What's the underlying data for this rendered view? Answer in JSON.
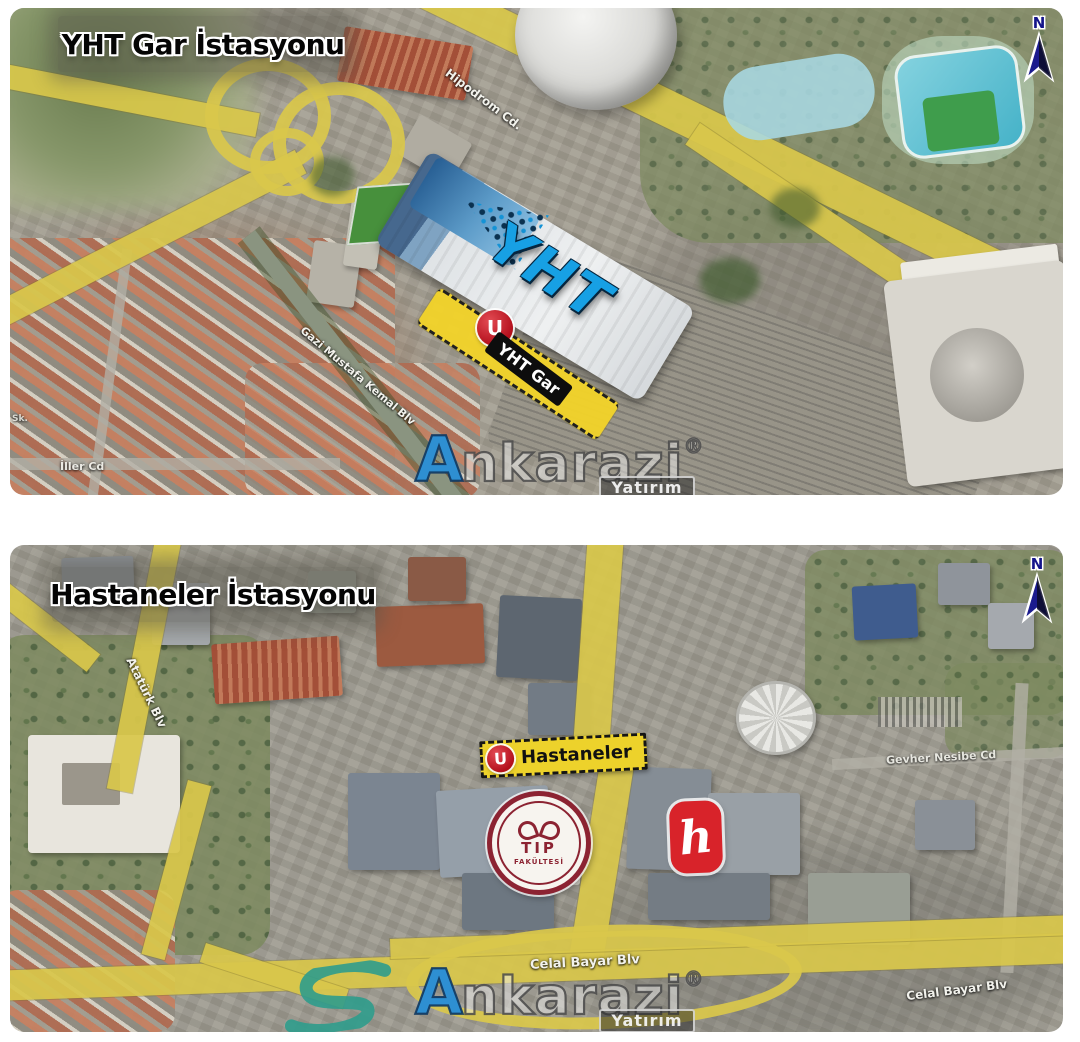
{
  "top_map": {
    "title": "YHT Gar İstasyonu",
    "north_label": "N",
    "station_building_text": "YHT",
    "station_marker": {
      "metro_symbol": "U",
      "label": "YHT Gar"
    },
    "street_labels": {
      "hipodrom": "Hipodrom Cd.",
      "gazi_mustafa_kemal": "Gazi Mustafa Kemal Blv",
      "iller": "İller Cd",
      "sokak": "Sk."
    }
  },
  "bottom_map": {
    "title": "Hastaneler İstasyonu",
    "north_label": "N",
    "station_marker": {
      "metro_symbol": "U",
      "label": "Hastaneler"
    },
    "street_labels": {
      "ataturk": "Atatürk Blv",
      "celal_bayar_center": "Celal Bayar Blv",
      "celal_bayar_right": "Celal Bayar Blv",
      "gevher_nesibe": "Gevher Nesibe Cd"
    },
    "tip_fakultesi_logo": {
      "line1": "TIP",
      "line2": "FAKÜLTESİ"
    },
    "hacettepe_logo_glyph": "h"
  },
  "watermark": {
    "initial": "A",
    "rest": "nkarazi",
    "registered": "®",
    "subtitle": "Yatırım"
  },
  "colors": {
    "highlight_road_yellow": "#d9c74b",
    "station_road_yellow": "#f2d32a",
    "metro_marker_red": "#c21a26",
    "yht_text_blue": "#17a0e4",
    "north_arrow_navy": "#1b1b8e",
    "tip_logo_maroon": "#8c2332",
    "hacettepe_red": "#d8232a",
    "brand_blue": "#2e8fd2"
  }
}
